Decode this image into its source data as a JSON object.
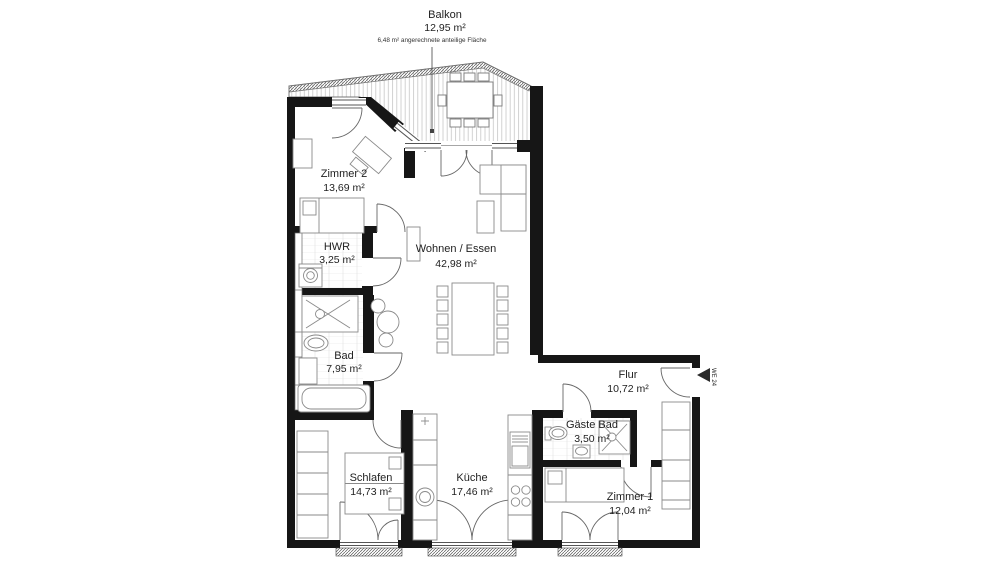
{
  "plan": {
    "balcony": {
      "name": "Balkon",
      "area": "12,95 m²",
      "note": "6,48 m² angerechnete anteilige Fläche"
    },
    "rooms": [
      {
        "key": "zimmer2",
        "name": "Zimmer 2",
        "area": "13,69 m²"
      },
      {
        "key": "hwr",
        "name": "HWR",
        "area": "3,25 m²"
      },
      {
        "key": "bad",
        "name": "Bad",
        "area": "7,95 m²"
      },
      {
        "key": "wohnen_essen",
        "name": "Wohnen / Essen",
        "area": "42,98 m²"
      },
      {
        "key": "flur",
        "name": "Flur",
        "area": "10,72 m²"
      },
      {
        "key": "gaeste_bad",
        "name": "Gäste Bad",
        "area": "3,50 m²"
      },
      {
        "key": "schlafen",
        "name": "Schlafen",
        "area": "14,73 m²"
      },
      {
        "key": "kueche",
        "name": "Küche",
        "area": "17,46 m²"
      },
      {
        "key": "zimmer1",
        "name": "Zimmer 1",
        "area": "12,04 m²"
      }
    ],
    "entrance": {
      "label": "WE 24"
    },
    "colors": {
      "wall": "#161616",
      "line": "#5a5a5a",
      "furniture": "#8a8a8a",
      "text": "#1f1f1f",
      "hatch": "#c2c2c2"
    }
  }
}
